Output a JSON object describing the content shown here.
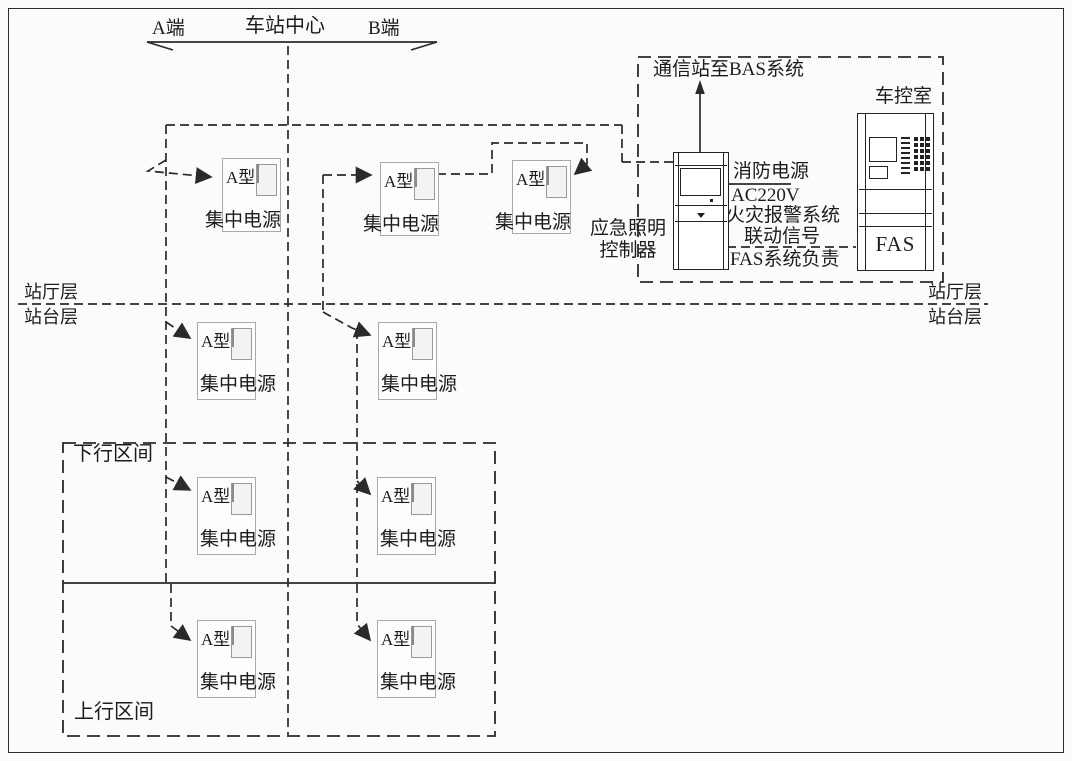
{
  "header": {
    "a_end": "A端",
    "station_center": "车站中心",
    "b_end": "B端"
  },
  "levels": {
    "hall": "站厅层",
    "platform": "站台层"
  },
  "sections": {
    "down": "下行区间",
    "up": "上行区间"
  },
  "unit": {
    "type_label": "A型",
    "name_label": "集中电源",
    "count": 9
  },
  "control_room": {
    "label": "车控室",
    "bas_link": "通信站至BAS系统"
  },
  "controller": {
    "name_line1": "应急照明",
    "name_line2": "控制器"
  },
  "annotations": {
    "fire_power": "消防电源",
    "voltage": "AC220V",
    "fire_alarm": "火灾报警系统",
    "linkage": "联动信号",
    "fas_duty": "FAS系统负责"
  },
  "fas_cabinet": {
    "label": "FAS"
  },
  "colors": {
    "line": "#2a2a2a",
    "unit_border": "#aaaaaa",
    "background": "#fbfbfa"
  }
}
